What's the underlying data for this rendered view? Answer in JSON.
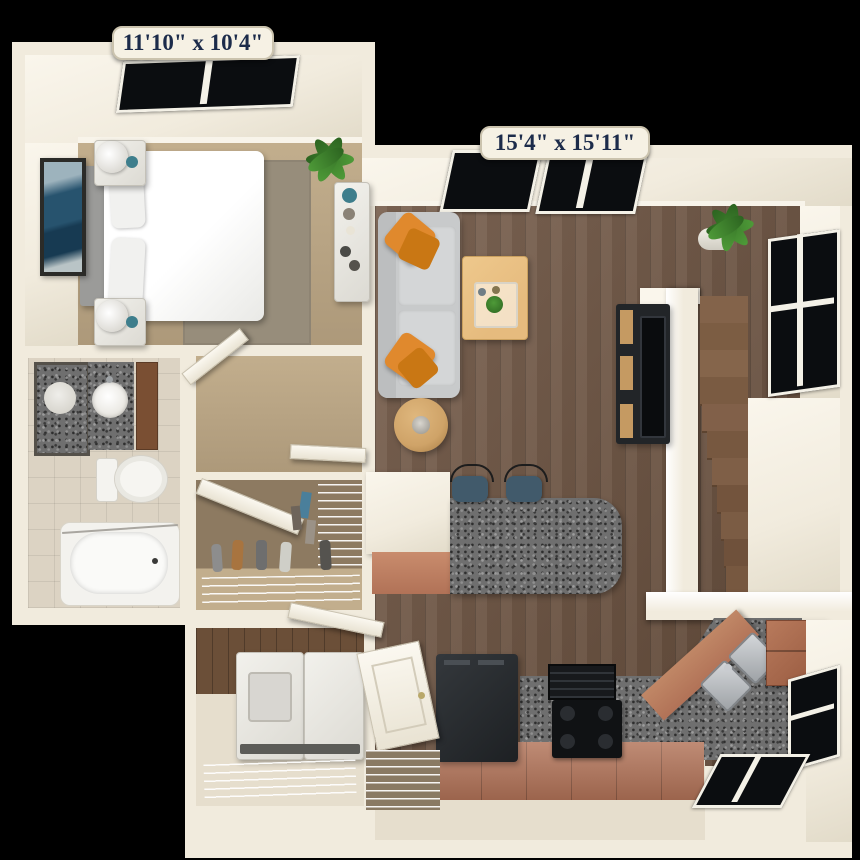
{
  "scene": {
    "type": "3d-apartment-floor-plan",
    "view": "top-down render",
    "background": "#000000"
  },
  "labels": {
    "bedroom_dimensions": "11'10\" x 10'4\"",
    "living_dimensions": "15'4\" x 15'11\""
  },
  "rooms": [
    {
      "name": "bedroom",
      "dimensions": "11'10\" x 10'4\"",
      "floor": "tan carpet",
      "furniture": [
        "queen-bed",
        "headboard",
        "nightstand-with-lamp",
        "nightstand-with-lamp",
        "wall-art",
        "area-rug",
        "potted-plant",
        "decor-shelf",
        "skylight-window"
      ]
    },
    {
      "name": "living-room",
      "dimensions": "15'4\" x 15'11\"",
      "floor": "dark hardwood",
      "furniture": [
        "gray-sofa",
        "orange-throw-pillows",
        "round-side-table",
        "coffee-table-with-tray",
        "tv-console",
        "television",
        "staircase",
        "potted-plant",
        "windows",
        "breakfast-bar",
        "bar-stools"
      ]
    },
    {
      "name": "bathroom",
      "floor": "beige tile",
      "furniture": [
        "vanity-mirror",
        "granite-vanity",
        "round-sink",
        "vanity-cabinet",
        "toilet",
        "bathtub"
      ]
    },
    {
      "name": "walk-in-closet",
      "furniture": [
        "open-door",
        "wire-shelving",
        "hanging-clothes",
        "shoe-rack"
      ]
    },
    {
      "name": "laundry-closet",
      "furniture": [
        "washer",
        "dryer",
        "wire-shelf",
        "open-door"
      ]
    },
    {
      "name": "kitchen",
      "floor": "dark hardwood",
      "furniture": [
        "refrigerator",
        "range-hood",
        "stove-cooktop",
        "granite-counters",
        "terracotta-cabinets",
        "double-sink",
        "upper-cabinet",
        "windows"
      ]
    },
    {
      "name": "entry",
      "furniture": [
        "front-door",
        "wire-pantry-shelf"
      ]
    }
  ],
  "colors": {
    "pageBg": "#000000",
    "wall": "#f1ebdd",
    "wallBright": "#faf6ec",
    "wallShade": "#e2dbc9",
    "labelBg": "#f6f1e4",
    "labelBorder": "#cbc3ae",
    "labelText": "#1c2b4a",
    "carpet": "#c2ae8d",
    "carpetDark": "#ad997a",
    "rug": "#978d7b",
    "tile": "#dcd3c3",
    "hardwood": "#6e5340",
    "granite": "#6f6f6f",
    "cabinet": "#b17257",
    "cabinetDark": "#9c5f43",
    "sofa": "#c8cacb",
    "sofaCushion": "#d4d6d7",
    "pillowOrange": "#e0892d",
    "tableWood": "#e6bb7e",
    "sideTable": "#cfa368",
    "stoolNavy": "#415a6b",
    "stairWood": "#7c5d43",
    "stairDark": "#5d4430",
    "tvDark": "#222528",
    "consoleWood": "#c59a62",
    "glass": "#0b0d10",
    "plant": "#4e9a38",
    "plantDark": "#2c6420",
    "teal": "#3e7e8c",
    "artBlue": "#27536e",
    "closetWall": "#8d7a61",
    "woodWall": "#6b4f38",
    "entryFloor": "#e6decd",
    "steel": "#c3c7ca"
  }
}
